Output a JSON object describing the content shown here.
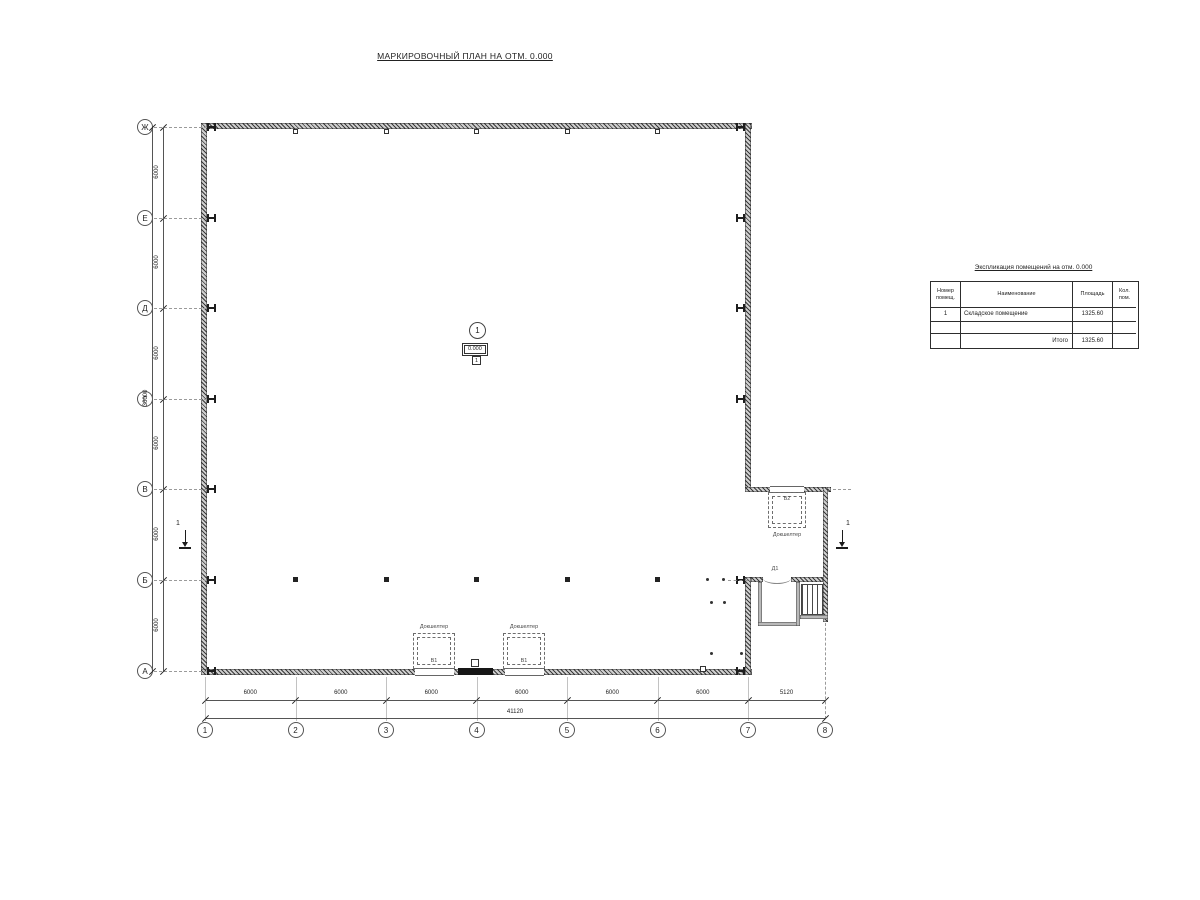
{
  "drawing": {
    "title": "МАРКИРОВОЧНЫЙ ПЛАН НА ОТМ. 0.000"
  },
  "axes": {
    "row_labels": [
      "Ж",
      "Е",
      "Д",
      "Г",
      "В",
      "Б",
      "А"
    ],
    "col_labels": [
      "1",
      "2",
      "3",
      "4",
      "5",
      "6",
      "7",
      "8"
    ]
  },
  "dimensions": {
    "left_segments": [
      "6000",
      "6000",
      "6000",
      "6000",
      "6000",
      "6000"
    ],
    "left_total": "36000",
    "bottom_segments": [
      "6000",
      "6000",
      "6000",
      "6000",
      "6000",
      "6000",
      "5120"
    ],
    "bottom_total": "41120"
  },
  "room_tag": {
    "number": "1",
    "elevation": "0.000",
    "floor_mark": "1"
  },
  "section_marks": {
    "left": "1",
    "right": "1"
  },
  "door_mark": "Д1",
  "dock_shelters": [
    {
      "label": "Докшелтер",
      "mark": "В1"
    },
    {
      "label": "Докшелтер",
      "mark": "В1"
    },
    {
      "label": "Докшелтер",
      "mark": "В2"
    }
  ],
  "schedule_table": {
    "title": "Экспликация помещений на отм. 0.000",
    "headers": [
      "Номер помещ.",
      "Наименование",
      "Площадь",
      "Кол. пом."
    ],
    "rows": [
      {
        "num": "1",
        "name": "Складское помещение",
        "area": "1325.60",
        "count": ""
      },
      {
        "num": "",
        "name": "",
        "area": "",
        "count": ""
      },
      {
        "num": "",
        "name": "Итого",
        "area": "1325.60",
        "count": ""
      }
    ]
  }
}
